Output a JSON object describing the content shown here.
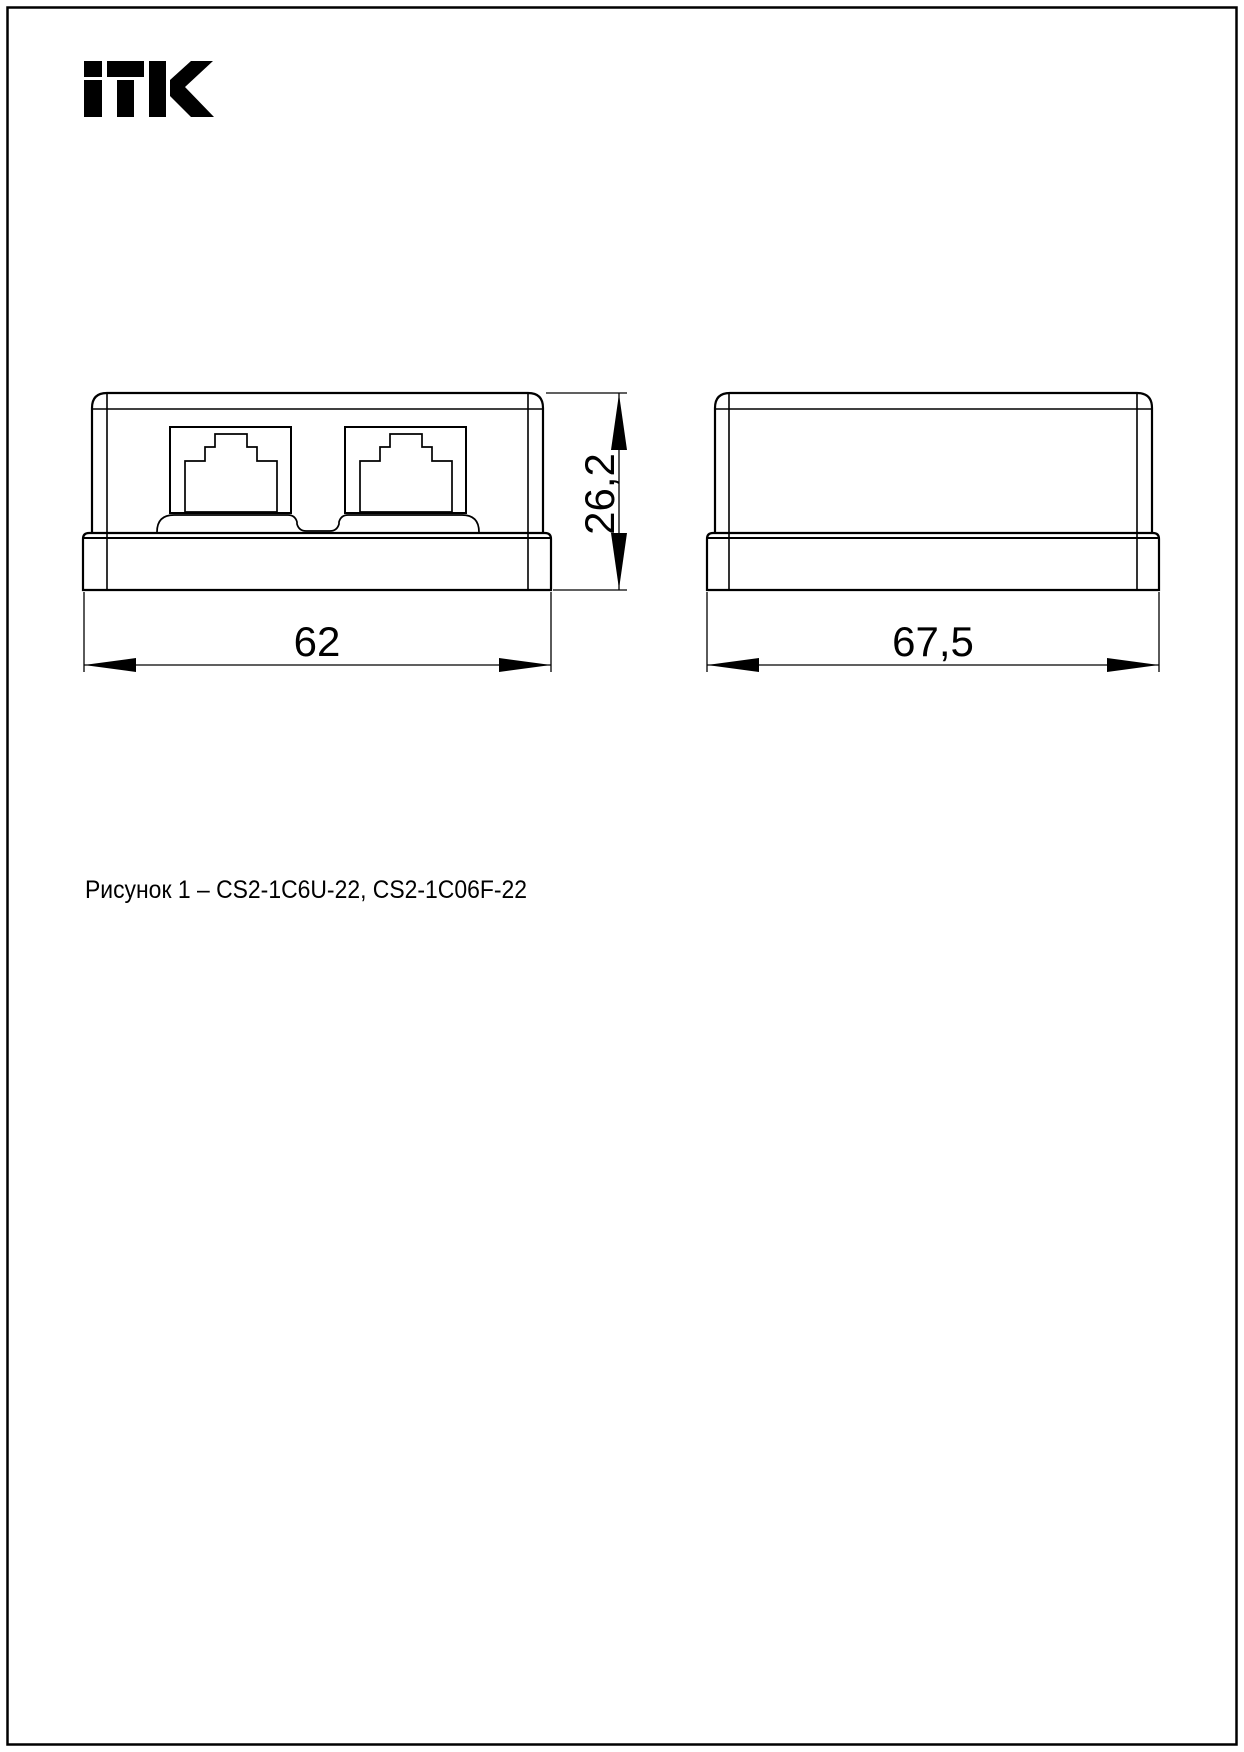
{
  "page": {
    "background": "#ffffff",
    "border_color": "#000000",
    "line_color": "#000000"
  },
  "logo": {
    "text": "ITK"
  },
  "figure": {
    "caption": "Рисунок 1 – CS2-1C6U-22, CS2-1C06F-22",
    "front_view": {
      "description": "front view, two RJ45 ports",
      "ports": 2,
      "width_dimension": "62",
      "height_dimension": "26,2"
    },
    "side_view": {
      "description": "side view",
      "width_dimension": "67,5"
    }
  }
}
